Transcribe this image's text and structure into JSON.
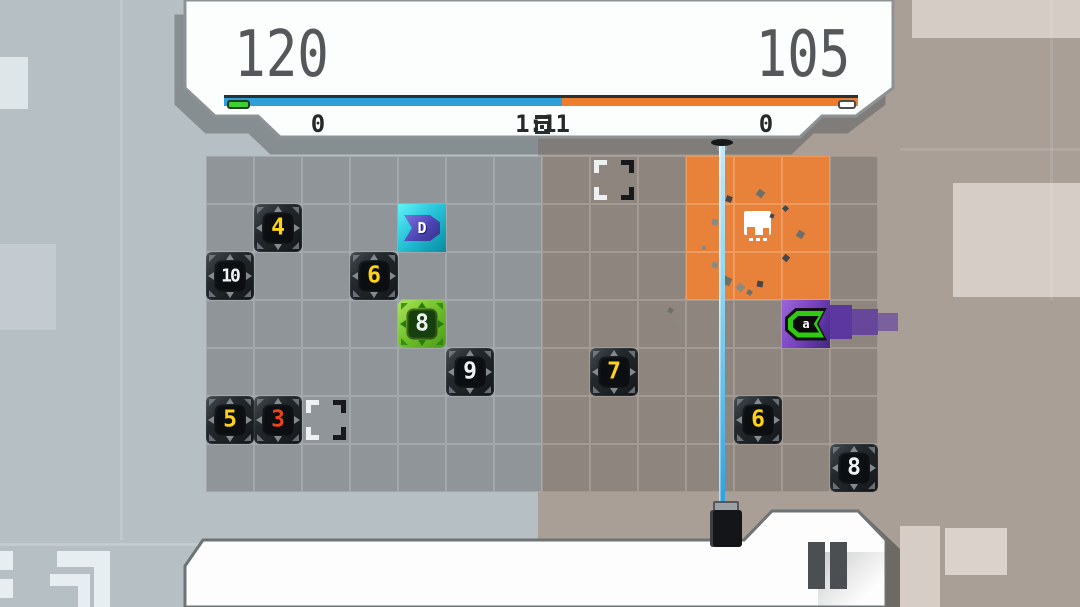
{
  "header": {
    "left_score": "120",
    "right_score": "105",
    "left_counter": "0",
    "right_counter": "0",
    "timer": "1:11",
    "progress": {
      "left_fraction": 0.533,
      "left_color": "#2f9fd8",
      "right_color": "#ee7d2e",
      "left_cap_color": "#3ecf35",
      "right_cap_color": "#ffffff"
    }
  },
  "board": {
    "cols": 14,
    "rows": 7,
    "cell_size": 48,
    "origin_x": 206,
    "origin_y": 156,
    "territory_split_col": 7,
    "orange_zone": {
      "col_start": 10,
      "row_start": 0,
      "col_end": 12,
      "row_end": 2
    },
    "tiles": [
      {
        "col": 1,
        "row": 1,
        "value": "4",
        "color": "yellow",
        "type": "dark"
      },
      {
        "col": 0,
        "row": 2,
        "value": "10",
        "color": "white",
        "type": "dark"
      },
      {
        "col": 3,
        "row": 2,
        "value": "6",
        "color": "yellow",
        "type": "dark"
      },
      {
        "col": 4,
        "row": 3,
        "value": "8",
        "color": "white",
        "type": "green"
      },
      {
        "col": 5,
        "row": 4,
        "value": "9",
        "color": "white",
        "type": "dark"
      },
      {
        "col": 0,
        "row": 5,
        "value": "5",
        "color": "yellow",
        "type": "dark"
      },
      {
        "col": 1,
        "row": 5,
        "value": "3",
        "color": "red",
        "type": "dark"
      },
      {
        "col": 8,
        "row": 4,
        "value": "7",
        "color": "yellow",
        "type": "dark"
      },
      {
        "col": 11,
        "row": 5,
        "value": "6",
        "color": "yellow",
        "type": "dark"
      },
      {
        "col": 13,
        "row": 6,
        "value": "8",
        "color": "white",
        "type": "dark"
      }
    ],
    "brackets": [
      {
        "col": 2,
        "row": 5
      },
      {
        "col": 8,
        "row": 0
      }
    ],
    "units": [
      {
        "side": "blue",
        "col": 4,
        "row": 1,
        "glyph": "D"
      },
      {
        "side": "purple",
        "col": 12,
        "row": 3,
        "glyph": "a"
      }
    ],
    "base": {
      "col": 11,
      "row": 1
    },
    "laser": {
      "x": 722,
      "beam_top": 146,
      "beam_bottom": 508
    },
    "debris": [
      {
        "x": 726,
        "y": 196,
        "s": 6,
        "r": 20
      },
      {
        "x": 757,
        "y": 190,
        "s": 7,
        "r": 35
      },
      {
        "x": 712,
        "y": 219,
        "s": 6,
        "r": 10
      },
      {
        "x": 783,
        "y": 206,
        "s": 5,
        "r": 45
      },
      {
        "x": 797,
        "y": 231,
        "s": 7,
        "r": 30
      },
      {
        "x": 712,
        "y": 262,
        "s": 6,
        "r": 15
      },
      {
        "x": 783,
        "y": 255,
        "s": 6,
        "r": 40
      },
      {
        "x": 723,
        "y": 277,
        "s": 8,
        "r": 25
      },
      {
        "x": 737,
        "y": 284,
        "s": 7,
        "r": 45
      },
      {
        "x": 757,
        "y": 281,
        "s": 6,
        "r": 10
      },
      {
        "x": 747,
        "y": 290,
        "s": 5,
        "r": 30
      },
      {
        "x": 702,
        "y": 246,
        "s": 4,
        "r": 0
      },
      {
        "x": 770,
        "y": 214,
        "s": 4,
        "r": 20
      },
      {
        "x": 668,
        "y": 308,
        "s": 5,
        "r": 30
      },
      {
        "x": 676,
        "y": 320,
        "s": 4,
        "r": 10
      }
    ]
  },
  "colors": {
    "bg_left": "#b6bfc3",
    "bg_right": "#a99f97",
    "cell_cool": "#8f9598",
    "cell_warm": "#8d857e",
    "cell_orange": "#e8823b",
    "laser": "#56b9e8",
    "blue_unit": "#2cc9dd",
    "purple_unit": "#7b44c2",
    "green_tile": "#71c02c"
  }
}
